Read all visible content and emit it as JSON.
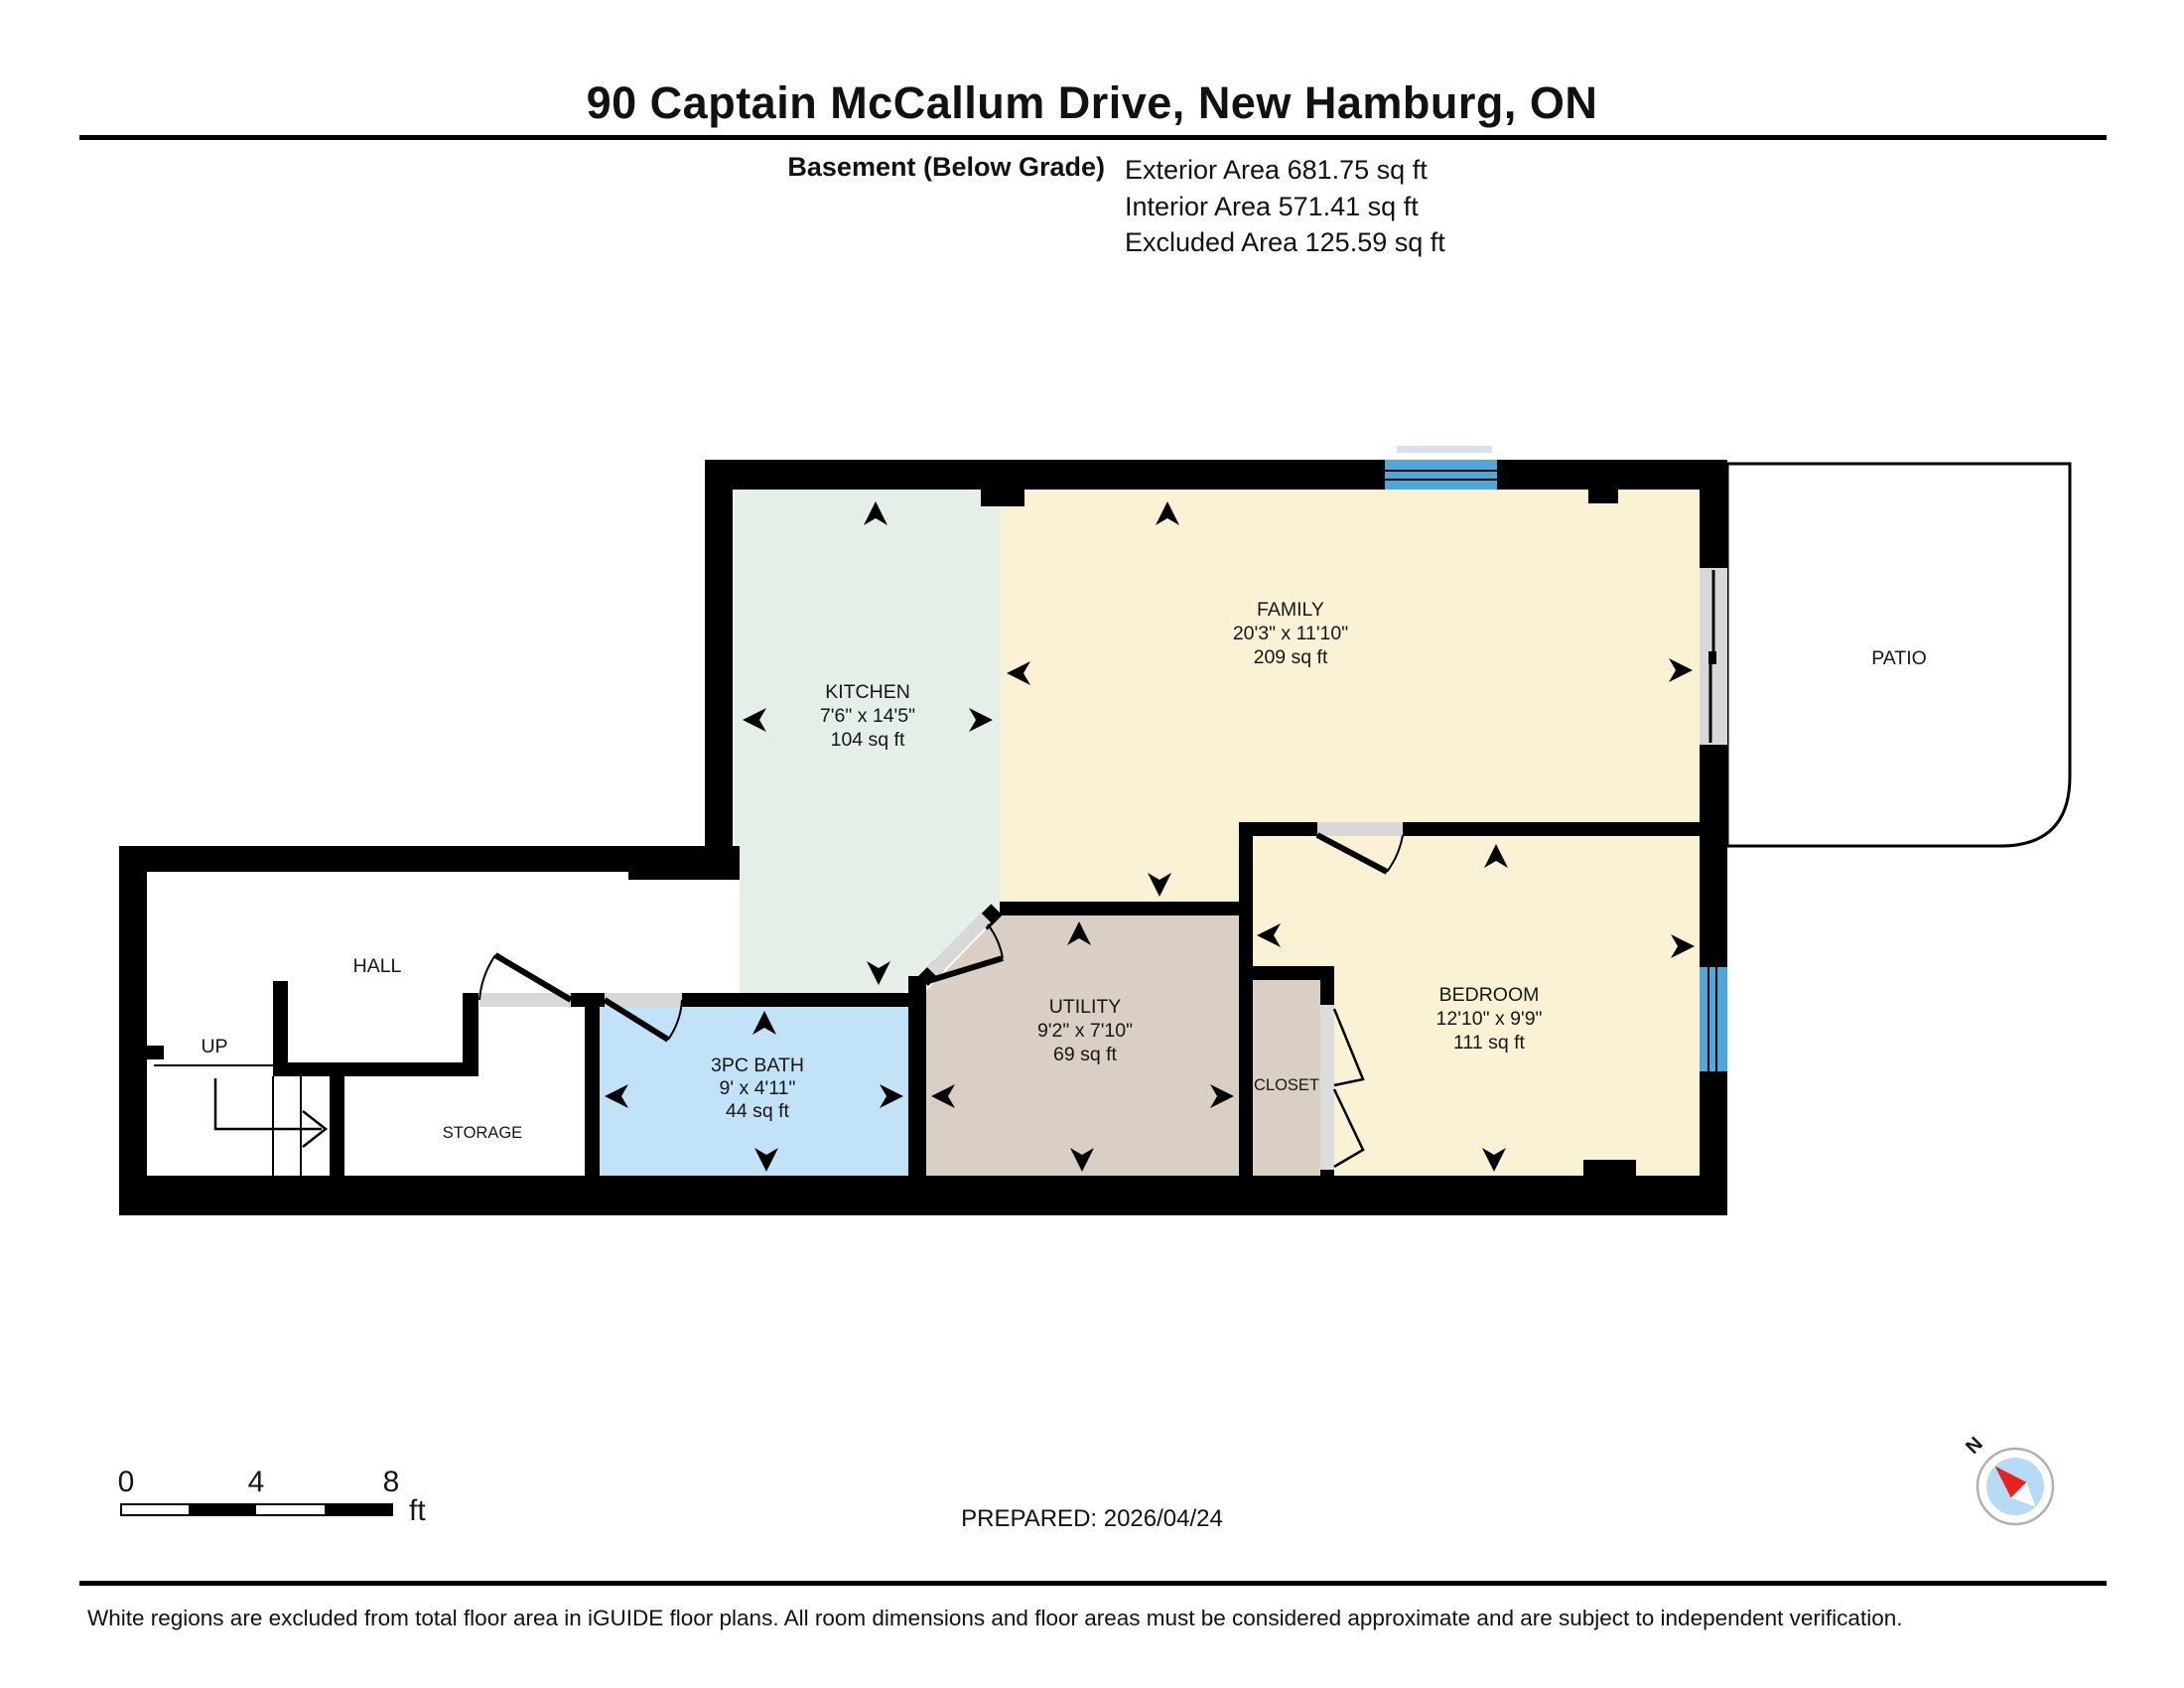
{
  "header": {
    "title": "90 Captain McCallum Drive, New Hamburg, ON",
    "floor_label": "Basement (Below Grade)",
    "areas": [
      {
        "label": "Exterior Area",
        "value": "681.75 sq ft"
      },
      {
        "label": "Interior Area",
        "value": "571.41 sq ft"
      },
      {
        "label": "Excluded Area",
        "value": "125.59 sq ft"
      }
    ]
  },
  "rooms": [
    {
      "name": "KITCHEN",
      "dimensions": "7'6\" x 14'5\"",
      "area": "104 sq ft"
    },
    {
      "name": "FAMILY",
      "dimensions": "20'3\" x 11'10\"",
      "area": "209 sq ft"
    },
    {
      "name": "BEDROOM",
      "dimensions": "12'10\" x 9'9\"",
      "area": "111 sq ft"
    },
    {
      "name": "UTILITY",
      "dimensions": "9'2\" x 7'10\"",
      "area": "69 sq ft"
    },
    {
      "name": "3PC BATH",
      "dimensions": "9' x 4'11\"",
      "area": "44 sq ft"
    },
    {
      "name": "HALL"
    },
    {
      "name": "STORAGE"
    },
    {
      "name": "CLOSET"
    },
    {
      "name": "PATIO"
    },
    {
      "name": "UP"
    }
  ],
  "scale_bar": {
    "tick_0": "0",
    "tick_4": "4",
    "tick_8": "8",
    "unit": "ft"
  },
  "prepared": {
    "label": "PREPARED:",
    "date": "2026/04/24"
  },
  "compass": {
    "north_label": "N"
  },
  "footer": {
    "disclaimer": "White regions are excluded from total floor area in iGUIDE floor plans. All room dimensions and floor areas must be considered approximate and are subject to independent verification."
  },
  "colors": {
    "wall": "#000000",
    "cream": "#fbf1d5",
    "kitchen": "#e5efe8",
    "bath": "#c2e2f8",
    "tan": "#d9cfc4",
    "window": "#4fa8dc",
    "door_gray": "#d8d8d8",
    "compass_blue": "#b5dcf4",
    "compass_red": "#e8201e"
  }
}
